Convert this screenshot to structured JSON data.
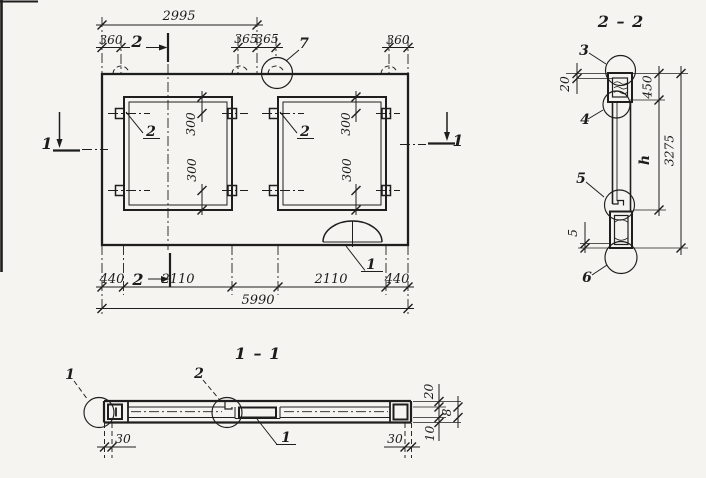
{
  "colors": {
    "paper": "#f5f4f0",
    "ink": "#1e1e1e"
  },
  "plan": {
    "dim_2995": "2995",
    "dim_360_left": "360",
    "dim_365_a": "365",
    "dim_365_b": "365",
    "dim_360_right": "360",
    "label_7": "7",
    "mark_2_top": "2",
    "mark_2_bottom": "2",
    "mark_1_left": "1",
    "mark_1_right": "1",
    "label_opening_left": "2",
    "label_opening_right": "2",
    "dim_300_left_top": "300",
    "dim_300_left_bottom": "300",
    "dim_300_right_top": "300",
    "dim_300_right_bottom": "300",
    "label_arch": "1",
    "dim_440_left": "440",
    "dim_2110_left": "2110",
    "dim_2110_right": "2110",
    "dim_440_right": "440",
    "dim_5990": "5990"
  },
  "section_2_2": {
    "title": "2 – 2",
    "label_3": "3",
    "label_4": "4",
    "label_5": "5",
    "label_6": "6",
    "dim_20": "20",
    "dim_450": "450",
    "dim_h": "h",
    "dim_3275": "3275",
    "dim_5": "5"
  },
  "section_1_1": {
    "title": "1 – 1",
    "label_1_left": "1",
    "label_2_center": "2",
    "label_1_insert": "1",
    "dim_30_left": "30",
    "dim_30_right": "30",
    "dim_20": "20",
    "dim_8": "8",
    "dim_10": "10"
  }
}
